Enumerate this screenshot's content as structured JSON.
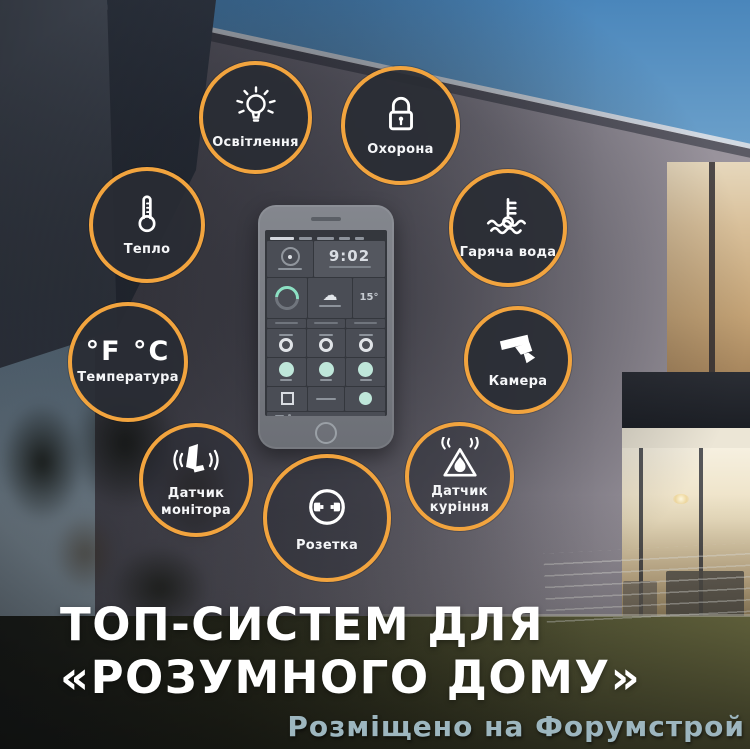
{
  "poster": {
    "title_line1": "ТОП-СИСТЕМ ДЛЯ",
    "title_line2": "«РОЗУМНОГО ДОМУ»",
    "watermark": "Розміщено на Форумстрой"
  },
  "features": [
    {
      "label": "Освітлення",
      "icon": "lightbulb-icon"
    },
    {
      "label": "Охорона",
      "icon": "padlock-icon"
    },
    {
      "label": "Тепло",
      "icon": "thermometer-icon"
    },
    {
      "label": "Гаряча вода",
      "icon": "hot-water-thermometer-icon"
    },
    {
      "label": "Температура",
      "icon": "temperature-units-icon",
      "icon_text": "°F °C"
    },
    {
      "label": "Камера",
      "icon": "cctv-camera-icon"
    },
    {
      "label": "Датчик\nмонітора",
      "icon": "door-sensor-icon"
    },
    {
      "label": "Датчик\nкуріння",
      "icon": "smoke-sensor-icon"
    },
    {
      "label": "Розетка",
      "icon": "power-socket-icon"
    }
  ],
  "phone_screen": {
    "clock": "9:02",
    "temperature": "15°"
  },
  "colors": {
    "ring_accent": "#F2A43E",
    "circle_fill": "#2A2D34",
    "toggle_active": "#BFE7DA",
    "title_text": "#FFFFFF",
    "watermark_text": "#9DB6BF"
  }
}
